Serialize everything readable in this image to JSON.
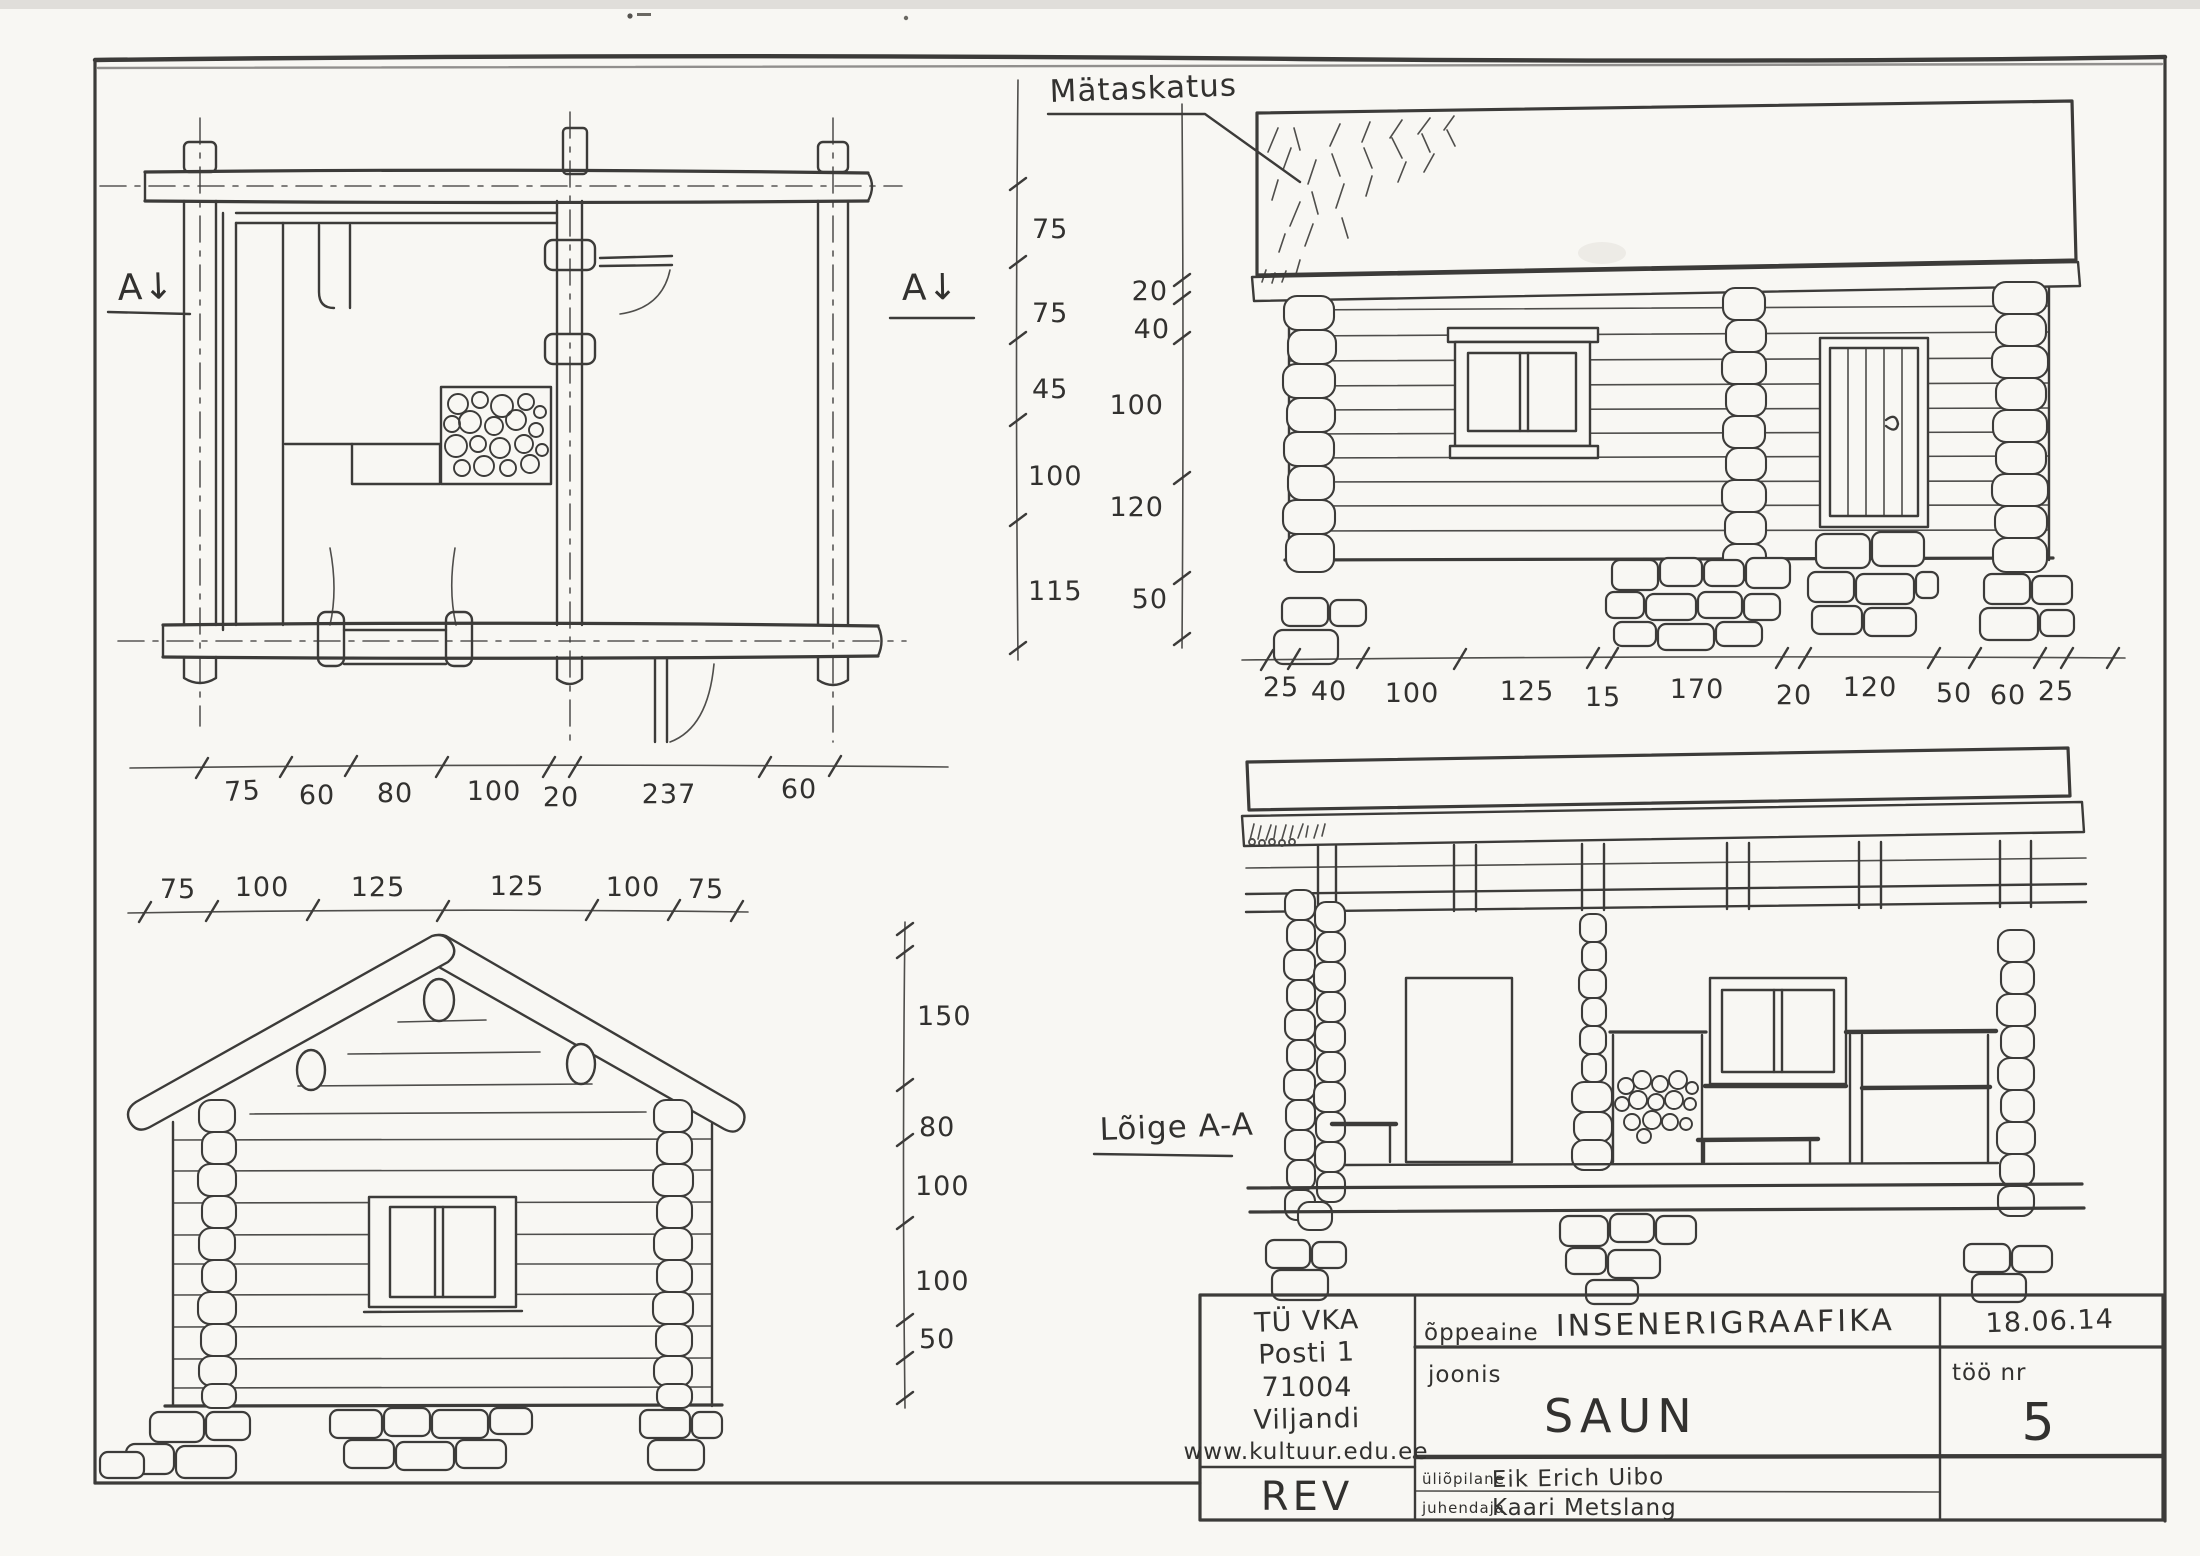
{
  "colors": {
    "ink": "#3c3b39",
    "paper": "#f8f7f3"
  },
  "plan": {
    "section_marker": "A↓",
    "bottom_dims": [
      "75",
      "60",
      "80",
      "100",
      "20",
      "237",
      "60"
    ],
    "height_dims": [
      "75",
      "75",
      "45",
      "100",
      "115"
    ]
  },
  "front_elevation": {
    "roof_label": "Mätaskatus",
    "height_dims": [
      "20",
      "40",
      "100",
      "120",
      "50"
    ],
    "bottom_dims": [
      "25",
      "40",
      "100",
      "125",
      "15",
      "170",
      "20",
      "120",
      "50",
      "60",
      "25"
    ]
  },
  "gable_elevation": {
    "top_dims": [
      "75",
      "100",
      "125",
      "125",
      "100",
      "75"
    ],
    "height_dims": [
      "150",
      "80",
      "100",
      "100",
      "50"
    ]
  },
  "section_view": {
    "label": "Lõige A-A"
  },
  "title_block": {
    "org_lines": [
      "TÜ VKA",
      "Posti 1",
      "71004",
      "Viljandi",
      "www.kultuur.edu.ee"
    ],
    "rev": "REV",
    "subject_label": "õppeaine",
    "subject_value": "INSENERIGRAAFIKA",
    "drawing_label": "joonis",
    "drawing_value": "SAUN",
    "date": "18.06.14",
    "work_nr_label": "töö nr",
    "work_nr_value": "5",
    "student_label": "üliõpilane",
    "student_value": "Eik Erich Uibo",
    "advisor_label": "juhendaja",
    "advisor_value": "Kaari Metslang"
  }
}
